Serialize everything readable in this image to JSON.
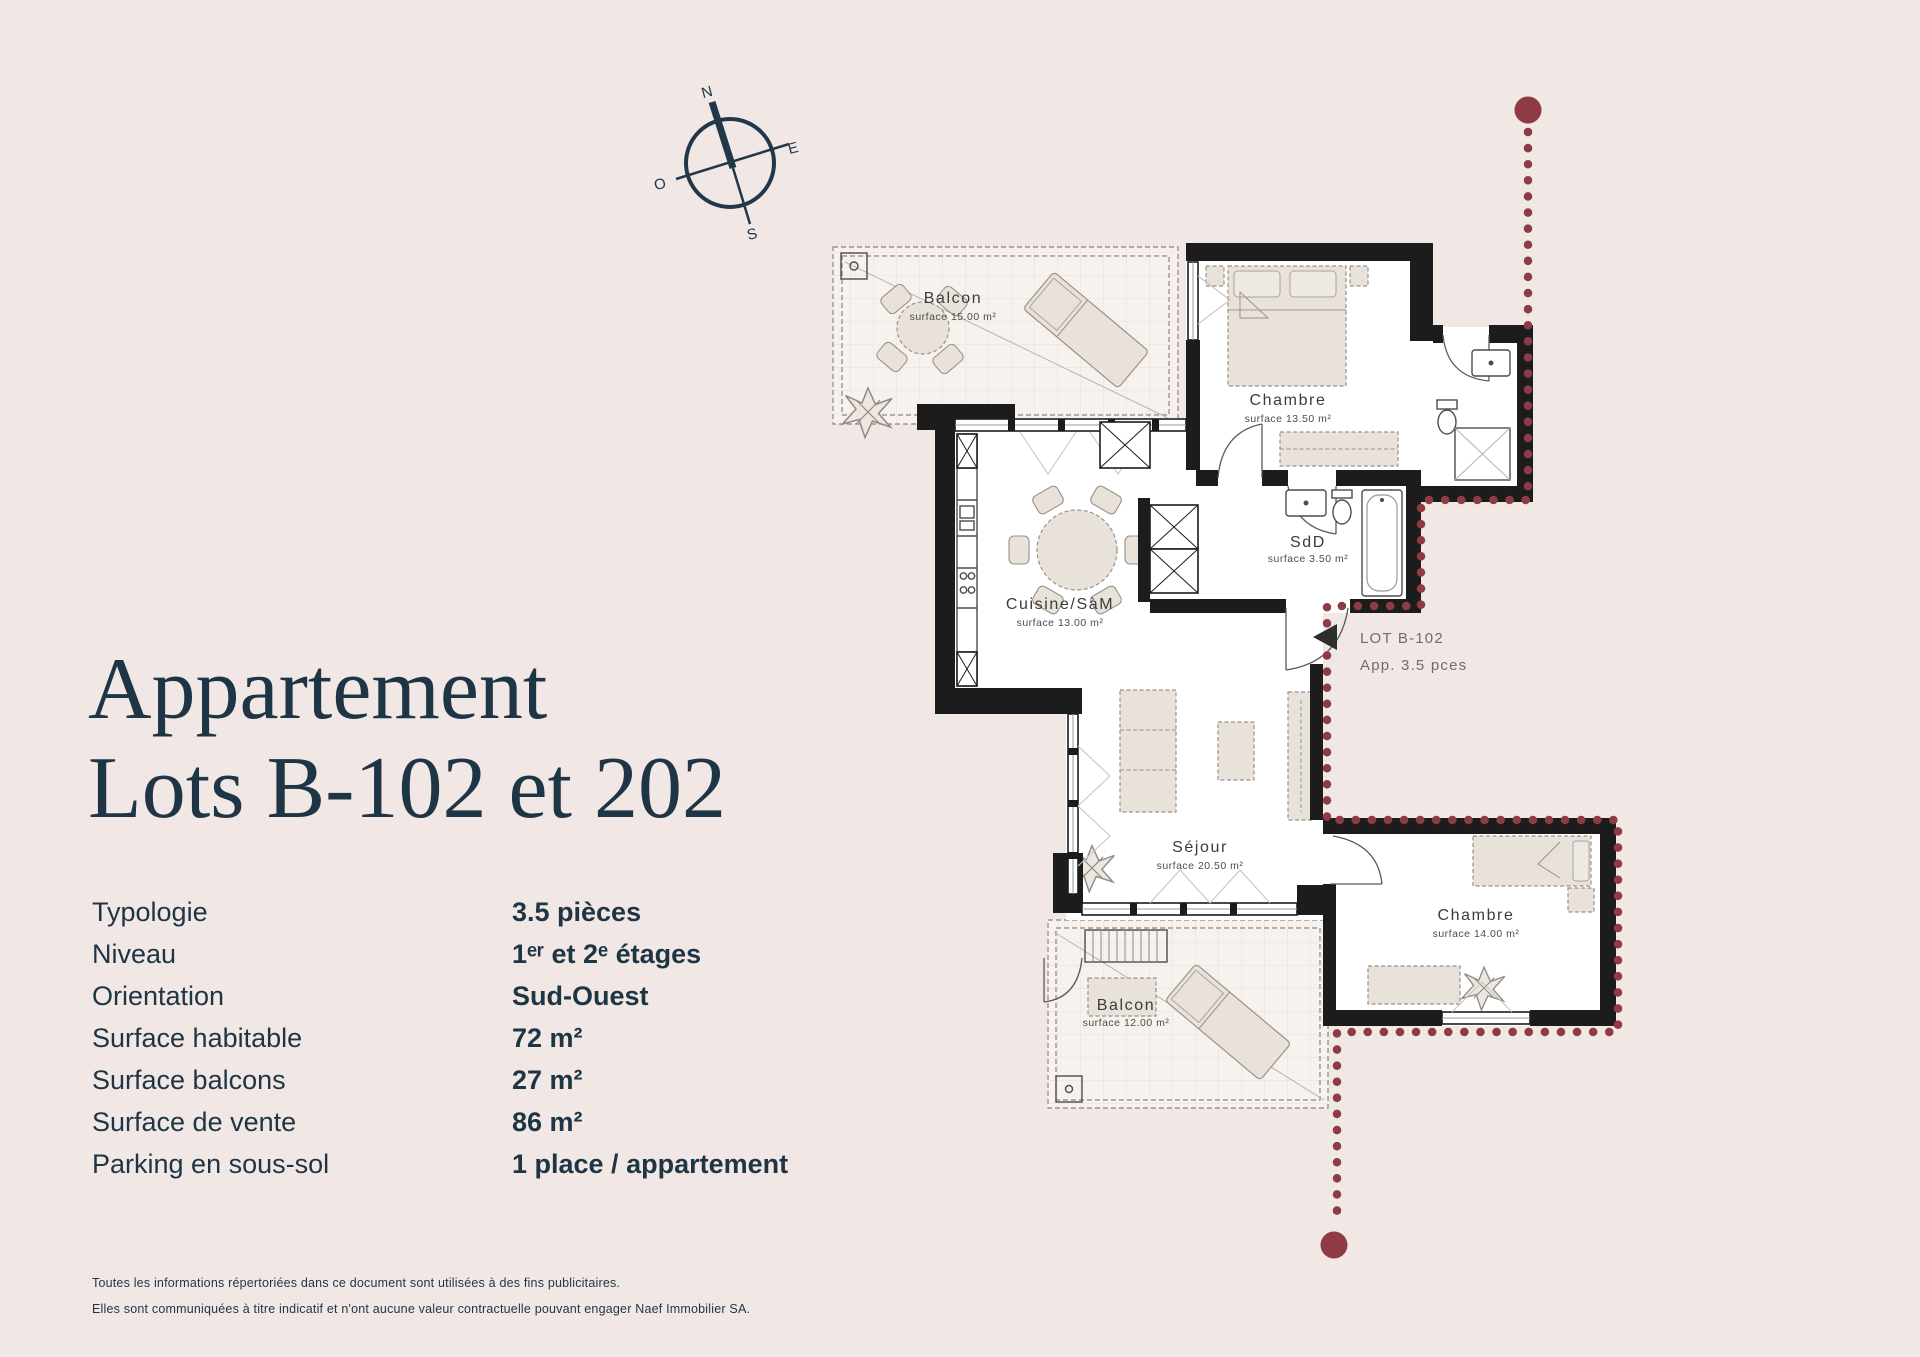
{
  "page": {
    "background": "#f1e7e4"
  },
  "title": {
    "line1": "Appartement",
    "line2": "Lots B-102 et 202"
  },
  "specs": {
    "rows": [
      {
        "label": "Typologie",
        "value": "3.5 pièces"
      },
      {
        "label": "Niveau",
        "value": "1ᵉʳ et 2ᵉ étages"
      },
      {
        "label": "Orientation",
        "value": "Sud-Ouest"
      },
      {
        "label": "Surface habitable",
        "value": "72 m²"
      },
      {
        "label": "Surface balcons",
        "value": "27 m²"
      },
      {
        "label": "Surface de vente",
        "value": "86 m²"
      },
      {
        "label": "Parking en sous-sol",
        "value": "1 place / appartement"
      }
    ]
  },
  "footer": {
    "line1": "Toutes les informations répertoriées dans ce document sont utilisées à des fins publicitaires.",
    "line2": "Elles sont communiquées à titre indicatif et n'ont aucune valeur contractuelle pouvant engager Naef Immobilier SA."
  },
  "compass": {
    "north": "N",
    "east": "E",
    "south": "S",
    "west": "O"
  },
  "plan": {
    "rooms": [
      {
        "name": "Balcon",
        "surface": "surface 15.00 m²"
      },
      {
        "name": "Chambre",
        "surface": "surface 13.50 m²"
      },
      {
        "name": "Cuisine/SàM",
        "surface": "surface 13.00 m²"
      },
      {
        "name": "SdD",
        "surface": "surface 3.50 m²"
      },
      {
        "name": "Séjour",
        "surface": "surface 20.50 m²"
      },
      {
        "name": "Chambre",
        "surface": "surface 14.00 m²"
      },
      {
        "name": "Balcon",
        "surface": "surface 12.00 m²"
      }
    ],
    "lot": {
      "line1": "LOT B-102",
      "line2": "App. 3.5 pces"
    }
  },
  "colors": {
    "accent_navy": "#1e3545",
    "lot_red": "#8e3b46"
  }
}
